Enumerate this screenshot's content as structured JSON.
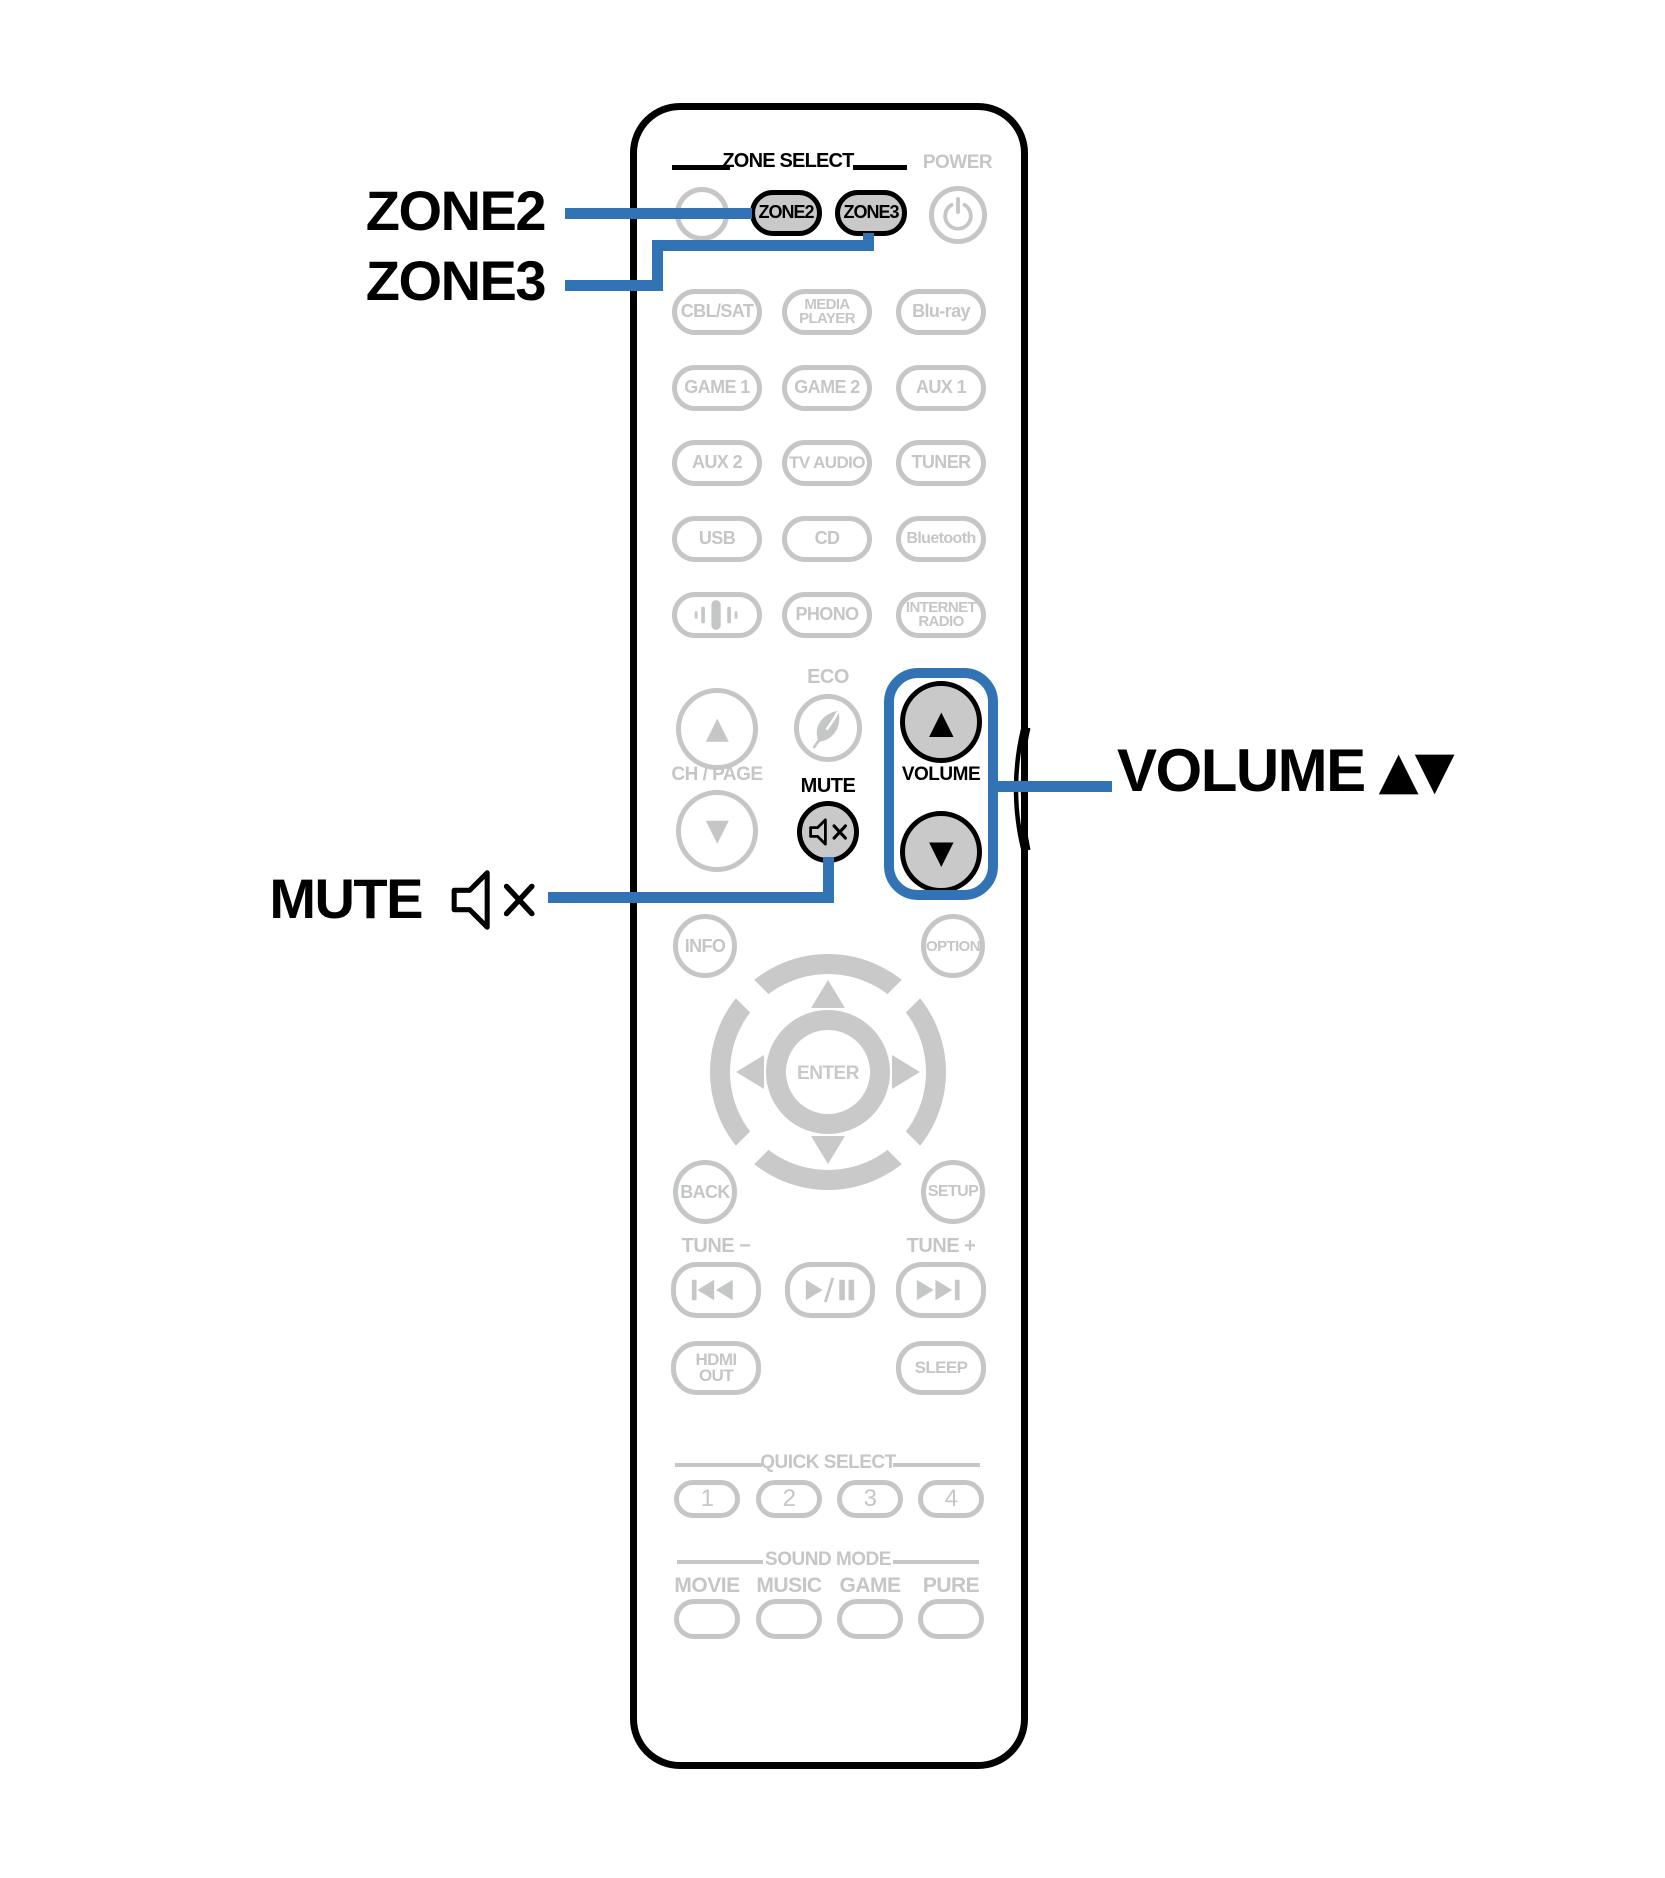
{
  "colors": {
    "accent_blue": "#3273b5",
    "active_button_fill": "#c9c9c9",
    "inactive_gray": "#c5c6c6",
    "outline_black": "#000000"
  },
  "callouts": {
    "zone2": "ZONE2",
    "zone3": "ZONE3",
    "mute": "MUTE",
    "volume": "VOLUME",
    "volume_arrows": "▲▼"
  },
  "remote": {
    "zone_select_title": "ZONE SELECT",
    "power_label": "POWER",
    "zone2": "ZONE2",
    "zone3": "ZONE3",
    "sources": {
      "cbl_sat": "CBL/SAT",
      "media_player": "MEDIA\nPLAYER",
      "blu_ray": "Blu-ray",
      "game1": "GAME 1",
      "game2": "GAME 2",
      "aux1": "AUX 1",
      "aux2": "AUX 2",
      "tv_audio": "TV AUDIO",
      "tuner": "TUNER",
      "usb": "USB",
      "cd": "CD",
      "bluetooth": "Bluetooth",
      "phono": "PHONO",
      "internet_radio": "INTERNET\nRADIO"
    },
    "eco_label": "ECO",
    "ch_page_label": "CH / PAGE",
    "mute_label": "MUTE",
    "volume_label": "VOLUME",
    "glyphs": {
      "up": "▲",
      "down": "▼"
    },
    "center": {
      "info": "INFO",
      "option": "OPTION",
      "enter": "ENTER",
      "back": "BACK",
      "setup": "SETUP"
    },
    "tune": {
      "minus": "TUNE −",
      "plus": "TUNE +"
    },
    "hdmi_out": "HDMI\nOUT",
    "sleep": "SLEEP",
    "quick_select": {
      "title": "QUICK SELECT",
      "buttons": [
        "1",
        "2",
        "3",
        "4"
      ]
    },
    "sound_mode": {
      "title": "SOUND MODE",
      "modes": [
        "MOVIE",
        "MUSIC",
        "GAME",
        "PURE"
      ]
    }
  }
}
